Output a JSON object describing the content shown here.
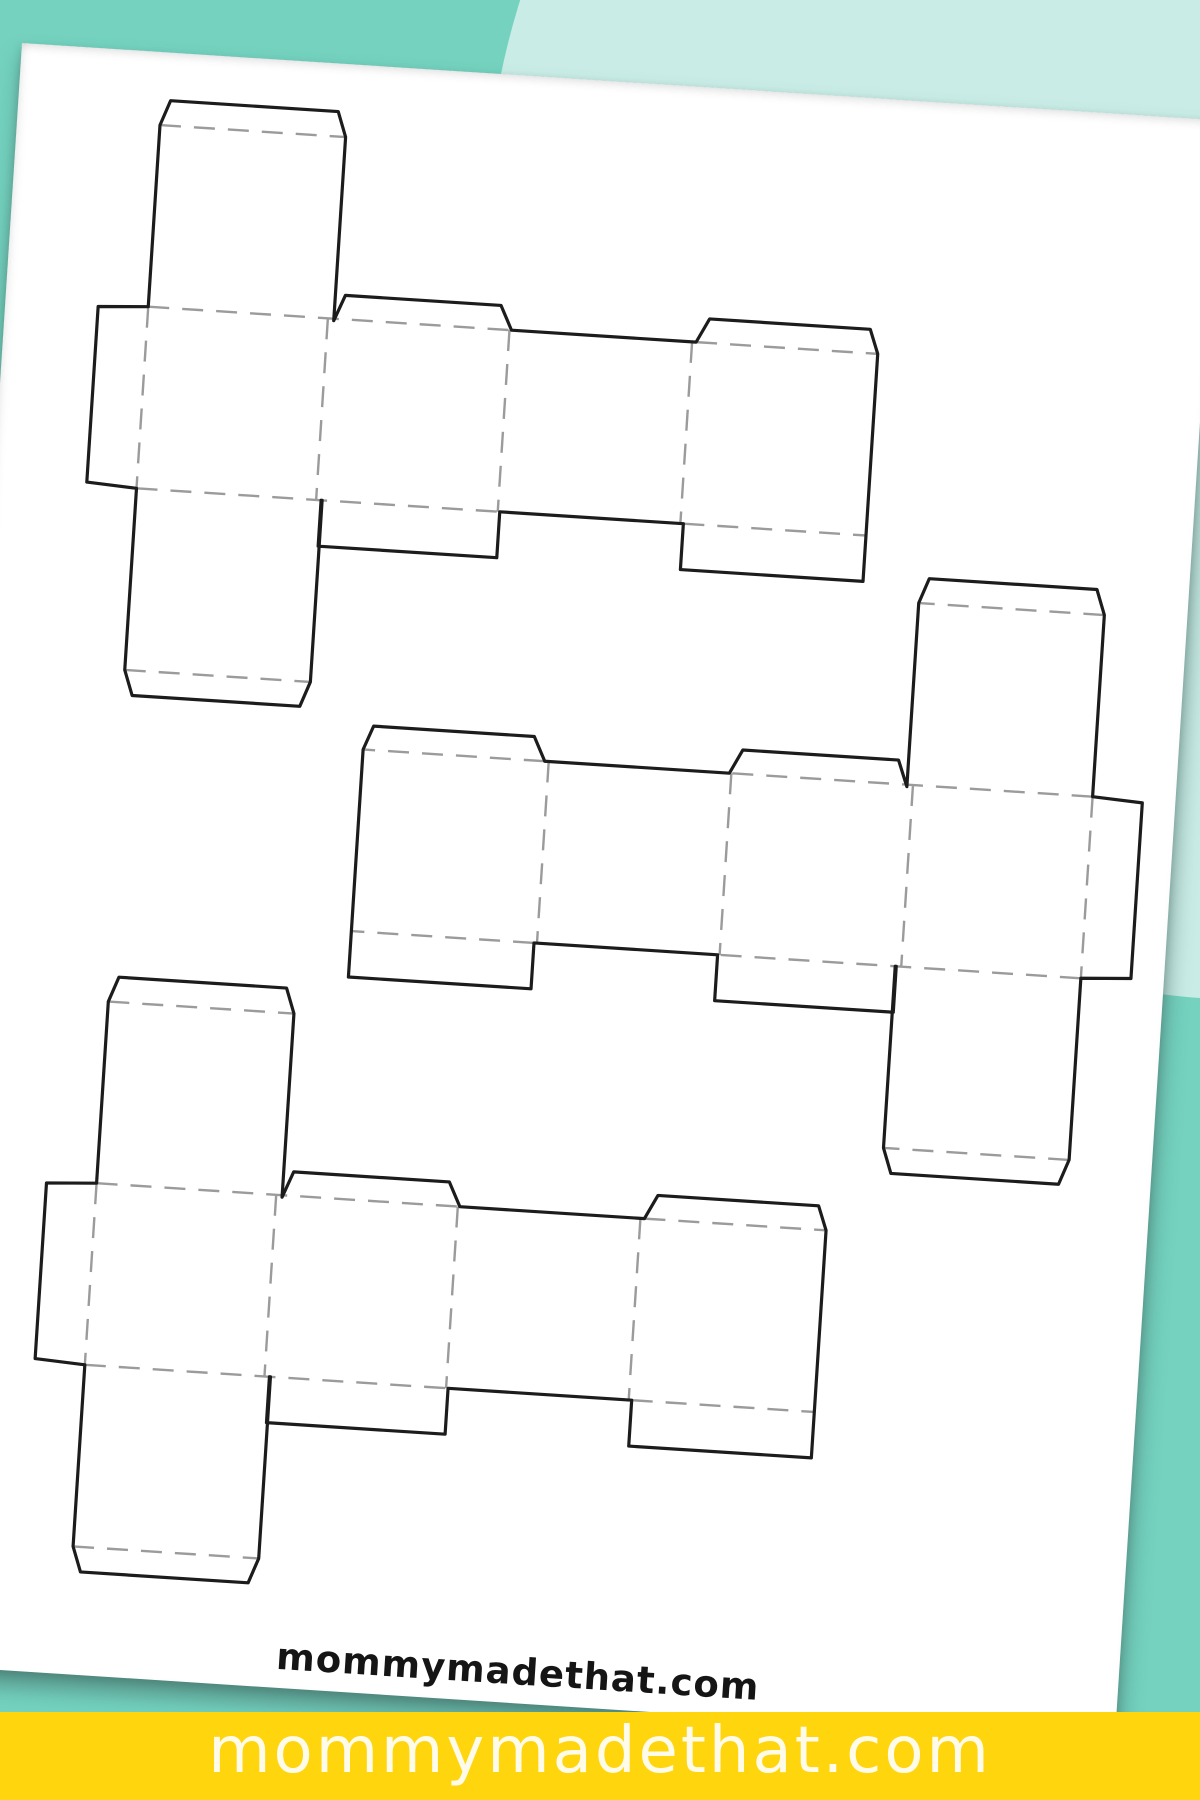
{
  "page": {
    "width": 1200,
    "height": 1800,
    "description": "Printable box templates sheet mockup"
  },
  "background": {
    "base_color": "#74D2BF",
    "accent_blob_color": "#C9ECE6"
  },
  "paper": {
    "color": "#FFFFFF",
    "rotation_deg": 3.7,
    "watermark": "mommymadethat.com",
    "watermark_color": "#151515"
  },
  "net": {
    "panel_widths": [
      172,
      190,
      183,
      186
    ],
    "strip_height": 182,
    "tab_width": 50,
    "lid_width": 186,
    "lid_height": 182,
    "lid_flap_height": 25,
    "end_flap_height": 24,
    "bottom_flap_height": 46,
    "cut_color": "#1c1c1c",
    "fold_color": "#9b9b9b"
  },
  "templates": [
    {
      "id": "box-template-1",
      "x": 143,
      "y": 255,
      "mirrored": false
    },
    {
      "id": "box-template-2",
      "x": 386,
      "y": 683,
      "mirrored": true
    },
    {
      "id": "box-template-3",
      "x": 148,
      "y": 1133,
      "mirrored": false
    }
  ],
  "banner": {
    "text": "mommymadethat.com",
    "bg_color": "#FFD60E",
    "text_color": "#FFFBEA"
  }
}
